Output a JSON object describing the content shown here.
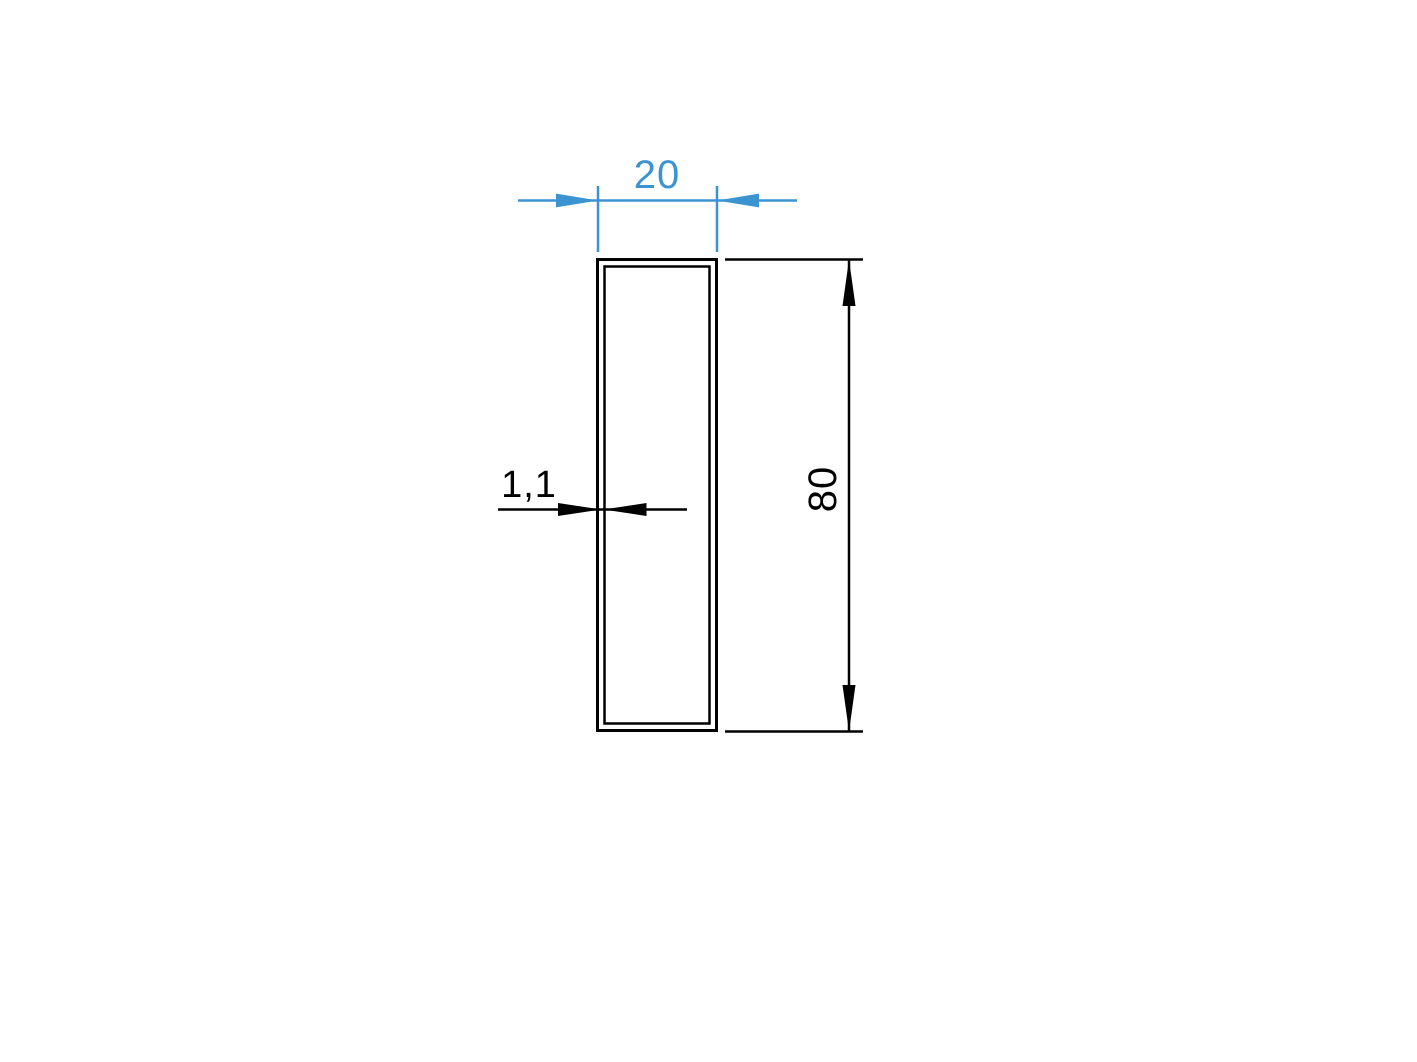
{
  "colors": {
    "background": "#ffffff",
    "dimension_blue": "#3b94d1",
    "drawing_black": "#010101"
  },
  "profile": {
    "width_dimension": {
      "label": "20"
    },
    "height_dimension": {
      "label": "80"
    },
    "wall_thickness_dimension": {
      "label": "1,1"
    }
  }
}
